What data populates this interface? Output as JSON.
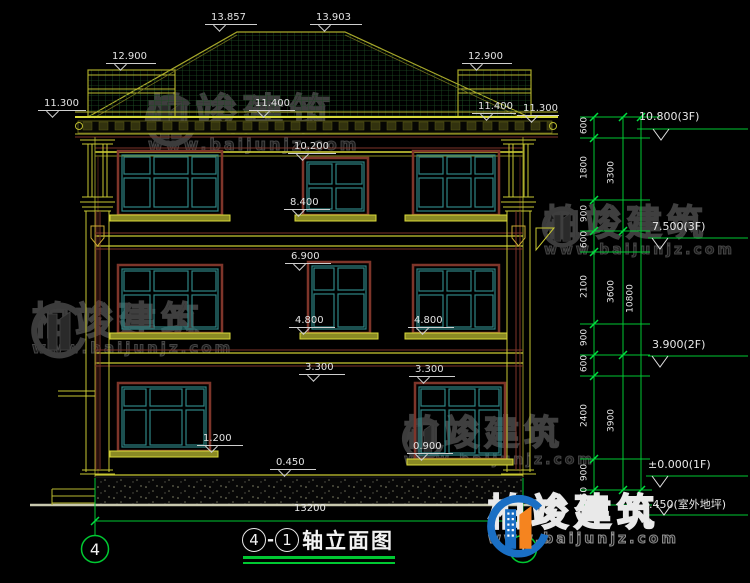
{
  "watermark": {
    "name": "柏竣建筑",
    "url": "www.baijunjz.com"
  },
  "brand_logo": {
    "name": "柏竣建筑",
    "url": "www.baijunjz.com"
  },
  "annotations": {
    "peak_left": "13.857",
    "peak_right": "13.903",
    "roof_upper_left": "12.900",
    "roof_upper_right": "12.900",
    "eave_left": "11.300",
    "eave_mid_left": "11.400",
    "eave_mid_right": "11.400",
    "eave_right": "11.300",
    "parapet_band": "10.200",
    "sill_3f": "8.400",
    "head_2f": "6.900",
    "sill_2f_left": "4.800",
    "sill_2f_right": "4.800",
    "head_1f_left": "3.300",
    "head_1f_right": "3.300",
    "sill_1f_left": "1.200",
    "sill_1f_right": "0.900",
    "plinth_top": "0.450"
  },
  "levels": {
    "roof": "10.800(3F)",
    "f3": "7.500(3F)",
    "f2": "3.900(2F)",
    "f1": "±0.000(1F)",
    "ground": "-0.450(室外地坪)"
  },
  "dim_chains": {
    "inner": [
      "600",
      "1800",
      "900",
      "600",
      "2100",
      "900",
      "600",
      "2400",
      "900",
      "450"
    ],
    "middle": [
      "3300",
      "3600",
      "3900"
    ],
    "outer": [
      "10800"
    ],
    "bottom_total": "13200"
  },
  "axes": {
    "left": "4",
    "right": "1"
  },
  "title": {
    "axis_start": "4",
    "dash": "-",
    "axis_end": "1",
    "name": "轴立面图"
  },
  "colors": {
    "dim_green": "#00c832",
    "line_yellow": "#c9c932",
    "frame_maroon": "#7e352a",
    "frame_teal": "#2e8585",
    "logo_blue": "#1a6fc4",
    "logo_orange": "#f5841f"
  }
}
